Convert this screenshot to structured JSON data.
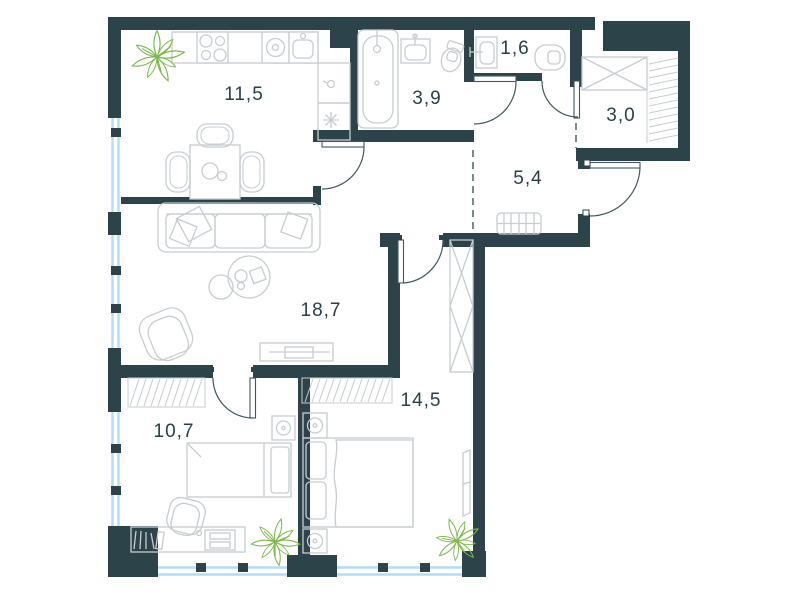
{
  "floorplan": {
    "title": "Apartment floor plan",
    "rooms": [
      {
        "id": "kitchen",
        "area_label": "11,5"
      },
      {
        "id": "bathroom",
        "area_label": "3,9"
      },
      {
        "id": "toilet",
        "area_label": "1,6"
      },
      {
        "id": "wardrobe-niche",
        "area_label": "3,0"
      },
      {
        "id": "hallway",
        "area_label": "5,4"
      },
      {
        "id": "living-room",
        "area_label": "18,7"
      },
      {
        "id": "bedroom-large",
        "area_label": "14,5"
      },
      {
        "id": "bedroom-small",
        "area_label": "10,7"
      }
    ],
    "colors": {
      "wall": "#2c4349",
      "furniture_outline": "#c7cdd0",
      "door_swing": "#42575d",
      "window_glass": "#b2ddf2",
      "plant": "#7cb94c",
      "label_text": "#2b4046",
      "background": "#ffffff"
    }
  }
}
